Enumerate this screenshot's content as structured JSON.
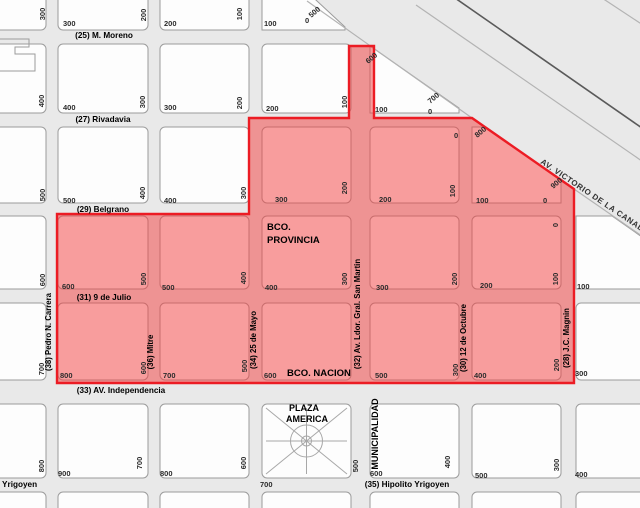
{
  "map": {
    "description": "City block map with red highlighted zone",
    "colors": {
      "background": "#e9e9e9",
      "block_fill": "#fdfdfd",
      "block_stroke": "#9c9c9c",
      "highlight_fill": "rgba(243,62,62,0.5)",
      "highlight_stroke": "#ec1c24"
    },
    "streets_h": [
      {
        "label": "(25) M. Moreno",
        "x": 104,
        "y": 38
      },
      {
        "label": "(27) Rivadavia",
        "x": 103,
        "y": 122
      },
      {
        "label": "(29) Belgrano",
        "x": 103,
        "y": 212
      },
      {
        "label": "(31) 9 de Julio",
        "x": 104,
        "y": 300
      },
      {
        "label": "(33) AV. Independencia",
        "x": 121,
        "y": 393
      },
      {
        "label": "(35) Hipolito Yrigoyen",
        "x": 407,
        "y": 487
      },
      {
        "label": "o Yrigoyen",
        "x": 16,
        "y": 487
      }
    ],
    "streets_v": [
      {
        "label": "(38) Pedro N. Carrera",
        "x": 51,
        "y": 332
      },
      {
        "label": "(36) Mitre",
        "x": 153,
        "y": 352
      },
      {
        "label": "(34) 25 de Mayo",
        "x": 256,
        "y": 340
      },
      {
        "label": "(32) Av. Ldor. Gral. San Martin",
        "x": 360,
        "y": 314
      },
      {
        "label": "(30) 12 de Octubre",
        "x": 466,
        "y": 338
      },
      {
        "label": "(28) J.C. Magnin",
        "x": 569,
        "y": 338
      }
    ],
    "avenue": {
      "label": "AV. VICTORIO DE LA CANAL",
      "x": 540,
      "y": 163,
      "angle": 34
    },
    "pois": [
      {
        "label": "BCO.",
        "x": 267,
        "y": 230,
        "anchor": "start"
      },
      {
        "label": "PROVINCIA",
        "x": 267,
        "y": 243,
        "anchor": "start"
      },
      {
        "label": "BCO. NACION",
        "x": 287,
        "y": 376,
        "anchor": "start"
      },
      {
        "label": "PLAZA",
        "x": 304,
        "y": 411,
        "anchor": "middle",
        "size": 9
      },
      {
        "label": "AMERICA",
        "x": 307,
        "y": 422,
        "anchor": "middle",
        "size": 9
      },
      {
        "label": "MUNICIPALIDAD",
        "x": 378,
        "y": 434,
        "anchor": "middle",
        "rot": -90,
        "size": 9
      }
    ],
    "numbers_h": [
      [
        "300",
        63,
        26
      ],
      [
        "200",
        164,
        26
      ],
      [
        "100",
        264,
        26
      ],
      [
        "400",
        63,
        110
      ],
      [
        "300",
        164,
        110
      ],
      [
        "200",
        266,
        111
      ],
      [
        "100",
        375,
        112
      ],
      [
        "500",
        63,
        203
      ],
      [
        "400",
        164,
        203
      ],
      [
        "300",
        275,
        202
      ],
      [
        "200",
        379,
        202
      ],
      [
        "100",
        476,
        203
      ],
      [
        "0",
        543,
        203
      ],
      [
        "600",
        62,
        289
      ],
      [
        "500",
        162,
        290
      ],
      [
        "400",
        265,
        290
      ],
      [
        "300",
        376,
        290
      ],
      [
        "200",
        480,
        288
      ],
      [
        "100",
        577,
        289
      ],
      [
        "800",
        60,
        378
      ],
      [
        "700",
        163,
        378
      ],
      [
        "600",
        264,
        378
      ],
      [
        "500",
        375,
        378
      ],
      [
        "400",
        474,
        378
      ],
      [
        "300",
        575,
        376
      ],
      [
        "900",
        58,
        476
      ],
      [
        "800",
        160,
        476
      ],
      [
        "600",
        370,
        476
      ],
      [
        "500",
        475,
        478
      ],
      [
        "400",
        575,
        477
      ],
      [
        "700",
        260,
        487
      ],
      [
        "0",
        305,
        23
      ],
      [
        "0",
        428,
        114
      ],
      [
        "0",
        454,
        138
      ]
    ],
    "numbers_rot": [
      [
        "300",
        45,
        14
      ],
      [
        "200",
        146,
        15
      ],
      [
        "100",
        242,
        14
      ],
      [
        "400",
        44,
        101
      ],
      [
        "300",
        145,
        102
      ],
      [
        "200",
        242,
        103
      ],
      [
        "100",
        347,
        102
      ],
      [
        "500",
        45,
        195
      ],
      [
        "400",
        145,
        193
      ],
      [
        "300",
        246,
        193
      ],
      [
        "200",
        347,
        188
      ],
      [
        "100",
        455,
        191
      ],
      [
        "600",
        45,
        280
      ],
      [
        "500",
        146,
        279
      ],
      [
        "400",
        246,
        278
      ],
      [
        "300",
        347,
        279
      ],
      [
        "200",
        457,
        279
      ],
      [
        "100",
        558,
        279
      ],
      [
        "0",
        558,
        225
      ],
      [
        "700",
        44,
        369
      ],
      [
        "600",
        146,
        368
      ],
      [
        "500",
        247,
        366
      ],
      [
        "300",
        458,
        370
      ],
      [
        "200",
        559,
        365
      ],
      [
        "800",
        44,
        466
      ],
      [
        "700",
        142,
        463
      ],
      [
        "600",
        246,
        463
      ],
      [
        "500",
        358,
        466
      ],
      [
        "400",
        450,
        462
      ],
      [
        "300",
        559,
        465
      ]
    ],
    "numbers_diag": [
      [
        "500",
        316,
        14
      ],
      [
        "600",
        373,
        60
      ],
      [
        "700",
        435,
        100
      ],
      [
        "800",
        482,
        134
      ],
      [
        "900",
        558,
        185
      ]
    ],
    "blocks": [
      {
        "r": [
          -12,
          -12,
          58,
          42
        ]
      },
      {
        "r": [
          -12,
          44,
          58,
          69
        ]
      },
      {
        "r": [
          -12,
          127,
          58,
          76
        ]
      },
      {
        "r": [
          -12,
          216,
          58,
          73
        ]
      },
      {
        "r": [
          -12,
          303,
          58,
          77
        ]
      },
      {
        "r": [
          -12,
          404,
          58,
          74
        ]
      },
      {
        "r": [
          -12,
          492,
          58,
          30
        ]
      },
      {
        "r": [
          58,
          -12,
          90,
          42
        ]
      },
      {
        "r": [
          58,
          44,
          90,
          69
        ]
      },
      {
        "r": [
          58,
          127,
          90,
          76
        ]
      },
      {
        "r": [
          58,
          216,
          90,
          73
        ]
      },
      {
        "r": [
          58,
          303,
          90,
          77
        ]
      },
      {
        "r": [
          58,
          404,
          90,
          74
        ]
      },
      {
        "r": [
          58,
          492,
          90,
          30
        ]
      },
      {
        "r": [
          160,
          -12,
          89,
          42
        ]
      },
      {
        "r": [
          160,
          44,
          89,
          69
        ]
      },
      {
        "r": [
          160,
          127,
          89,
          76
        ]
      },
      {
        "r": [
          160,
          216,
          89,
          73
        ]
      },
      {
        "r": [
          160,
          303,
          89,
          77
        ]
      },
      {
        "r": [
          160,
          404,
          89,
          74
        ]
      },
      {
        "r": [
          160,
          492,
          89,
          30
        ]
      },
      {
        "p": [
          [
            262,
            -12
          ],
          [
            303,
            -12
          ],
          [
            345,
            27
          ],
          [
            345,
            30
          ],
          [
            262,
            30
          ]
        ]
      },
      {
        "r": [
          262,
          44,
          89,
          69
        ]
      },
      {
        "r": [
          262,
          127,
          89,
          76
        ]
      },
      {
        "r": [
          262,
          216,
          89,
          73
        ]
      },
      {
        "r": [
          262,
          303,
          89,
          77
        ]
      },
      {
        "r": [
          262,
          404,
          89,
          74
        ]
      },
      {
        "r": [
          262,
          492,
          89,
          30
        ]
      },
      {
        "p": [
          [
            370,
            46
          ],
          [
            459,
            108
          ],
          [
            459,
            113
          ],
          [
            370,
            113
          ]
        ]
      },
      {
        "r": [
          370,
          127,
          89,
          76
        ]
      },
      {
        "r": [
          370,
          216,
          89,
          73
        ]
      },
      {
        "r": [
          370,
          303,
          89,
          77
        ]
      },
      {
        "r": [
          370,
          404,
          89,
          74
        ]
      },
      {
        "r": [
          370,
          492,
          89,
          30
        ]
      },
      {
        "p": [
          [
            472,
            127
          ],
          [
            486,
            127
          ],
          [
            561,
            180
          ],
          [
            561,
            203
          ],
          [
            472,
            203
          ]
        ]
      },
      {
        "r": [
          472,
          216,
          89,
          73
        ]
      },
      {
        "r": [
          472,
          303,
          89,
          77
        ]
      },
      {
        "r": [
          472,
          404,
          89,
          74
        ]
      },
      {
        "r": [
          472,
          492,
          89,
          30
        ]
      },
      {
        "p": [
          [
            576,
            216
          ],
          [
            612,
            216
          ],
          [
            652,
            244
          ],
          [
            652,
            289
          ],
          [
            576,
            289
          ]
        ]
      },
      {
        "r": [
          576,
          303,
          76,
          77
        ]
      },
      {
        "r": [
          576,
          404,
          76,
          74
        ]
      },
      {
        "r": [
          576,
          492,
          76,
          30
        ]
      }
    ],
    "red_polygon": [
      [
        349,
        46
      ],
      [
        374,
        46
      ],
      [
        374,
        118
      ],
      [
        472,
        118
      ],
      [
        574,
        189
      ],
      [
        574,
        383
      ],
      [
        57,
        383
      ],
      [
        57,
        214
      ],
      [
        249,
        214
      ],
      [
        249,
        118
      ],
      [
        349,
        118
      ]
    ],
    "diag_lines": [
      {
        "x1": 307,
        "y1": 1,
        "x2": 472,
        "y2": 118,
        "dark": false
      },
      {
        "x1": 416,
        "y1": 5,
        "x2": 652,
        "y2": 168,
        "dark": false
      },
      {
        "x1": 574,
        "y1": 189,
        "x2": 652,
        "y2": 243,
        "dark": false
      },
      {
        "x1": 455,
        "y1": -2,
        "x2": 652,
        "y2": 135,
        "dark": true
      },
      {
        "x1": 602,
        "y1": -2,
        "x2": 652,
        "y2": 31,
        "dark": false
      }
    ],
    "building_path": "M -2 39 H 29 V 47 H 15 V 54 H 35 V 71 H -2",
    "plaza": {
      "x": 266,
      "y": 408,
      "w": 81,
      "h": 66,
      "r": 16,
      "r2": 5
    }
  }
}
